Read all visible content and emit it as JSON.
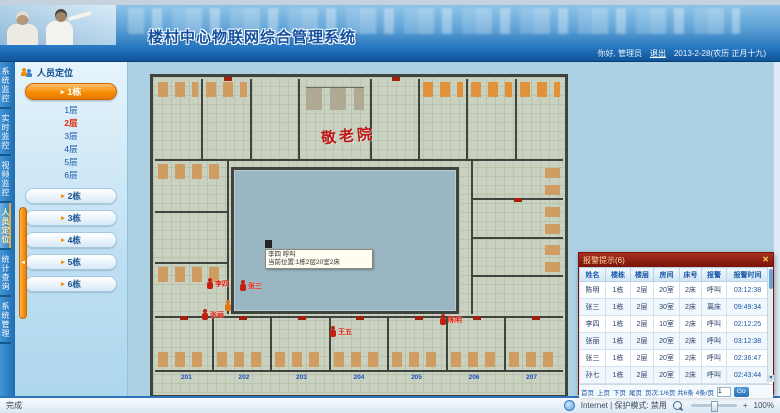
{
  "header": {
    "title": "楼村中心物联网综合管理系统",
    "greeting": "你好, 管理员",
    "logout": "退出",
    "date": "2013-2-28(农历 正月十九)"
  },
  "nav": {
    "tabs": [
      {
        "label": "系统监控"
      },
      {
        "label": "实时监控"
      },
      {
        "label": "视频监控"
      },
      {
        "label": "人员定位"
      },
      {
        "label": "统计查询"
      },
      {
        "label": "系统管理"
      }
    ]
  },
  "sidebar": {
    "title": "人员定位",
    "building_active": "1栋",
    "floors": [
      {
        "label": "1层"
      },
      {
        "label": "2层"
      },
      {
        "label": "3层"
      },
      {
        "label": "4层"
      },
      {
        "label": "5层"
      },
      {
        "label": "6层"
      }
    ],
    "buildings": [
      {
        "label": "2栋"
      },
      {
        "label": "3栋"
      },
      {
        "label": "4栋"
      },
      {
        "label": "5栋"
      },
      {
        "label": "6栋"
      }
    ],
    "collapse": "◄"
  },
  "map": {
    "calligraphy": "敬老院",
    "tooltip_line1": "李四 呼叫",
    "tooltip_line2": "当前位置:1栋2层20室2床",
    "persons": [
      {
        "name": "李四"
      },
      {
        "name": "张三"
      },
      {
        "name": "张丽"
      },
      {
        "name": "王五"
      },
      {
        "name": "陈明"
      }
    ],
    "room_labels": [
      "201",
      "202",
      "203",
      "204",
      "205",
      "206",
      "207"
    ]
  },
  "alarm": {
    "title": "报警提示(6)",
    "close": "✕",
    "columns": [
      "姓名",
      "楼栋",
      "楼层",
      "房间",
      "床号",
      "报警",
      "报警时间"
    ],
    "rows": [
      [
        "陈明",
        "1栋",
        "2层",
        "20室",
        "2床",
        "呼叫",
        "03:12:38"
      ],
      [
        "张三",
        "1栋",
        "2层",
        "30室",
        "2床",
        "离床",
        "09:49:34"
      ],
      [
        "李四",
        "1栋",
        "2层",
        "10室",
        "2床",
        "呼叫",
        "02:12:25"
      ],
      [
        "张丽",
        "1栋",
        "2层",
        "20室",
        "2床",
        "呼叫",
        "03:12:38"
      ],
      [
        "张三",
        "1栋",
        "2层",
        "20室",
        "2床",
        "呼叫",
        "02:36:47"
      ],
      [
        "孙七",
        "1栋",
        "2层",
        "20室",
        "2床",
        "呼叫",
        "02:43:44"
      ]
    ],
    "pager": {
      "first": "首页",
      "prev": "上页",
      "next": "下页",
      "last": "尾页",
      "info": "页次:1/6页 共6条 4条/页",
      "goto": "1",
      "go": "Go"
    },
    "scroll_down": "▼"
  },
  "status": {
    "left": "完成",
    "zone": "Internet | 保护模式: 禁用",
    "zoom": "100%",
    "plus": "+"
  },
  "colors": {
    "accent_orange": "#f68a00",
    "alarm_red": "#7a1208",
    "link_blue": "#1a56a8"
  }
}
